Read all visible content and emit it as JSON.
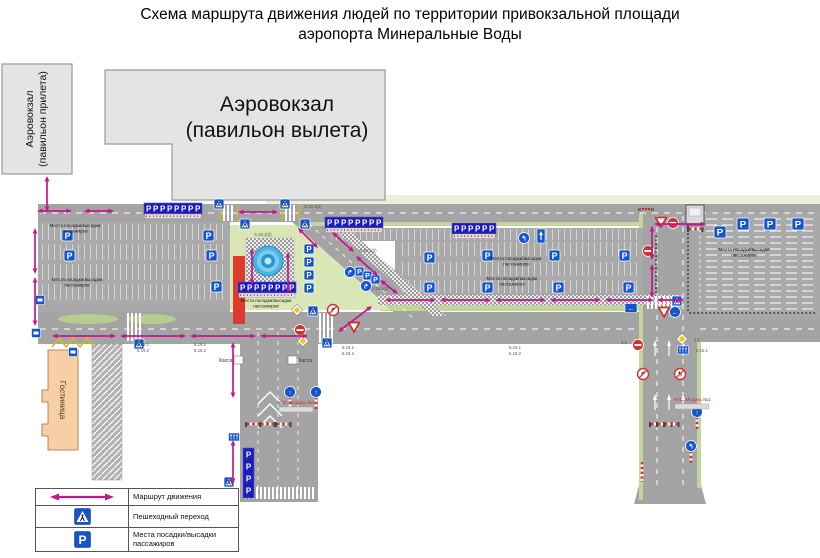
{
  "title": {
    "line1": "Схема маршрута движения людей по территории привокзальной площади",
    "line2": "аэропорта Минеральные Воды"
  },
  "buildings": {
    "arrival_line1": "Аэровокзал",
    "arrival_line2": "(павильон прилета)",
    "departure_line1": "Аэровокзал",
    "departure_line2": "(павильон вылета)",
    "hotel": "Гостиница"
  },
  "legend": {
    "route": "Маршрут движения",
    "crosswalk": "Пешеходный переход",
    "boarding": "Места посадки/высадки пассажиров",
    "p_letter": "P"
  },
  "colors": {
    "route": "#c2188c",
    "sign_blue": "#1455cc",
    "row_blue": "#1c1cb8",
    "road": "#a4a4a4",
    "green": "#d9e6b5",
    "fountain": "#49b4e6",
    "red_strip": "#e03a2e",
    "hotel": "#f6cfa6",
    "building": "#e4e4e4",
    "aps_red": "#d42222",
    "sign_red": "#d43030"
  },
  "map": {
    "p_letter": "P",
    "boarding_line1": "Места посадки/высадки",
    "boarding_line2": "пассажиров",
    "boarding_positions": [
      [
        75,
        227
      ],
      [
        77,
        281
      ],
      [
        266,
        302
      ],
      [
        516,
        260
      ],
      [
        512,
        280
      ],
      [
        744,
        251
      ]
    ],
    "kassa": {
      "label": "Касса",
      "positions": [
        [
          234,
          356,
          "left"
        ],
        [
          288,
          356,
          "right"
        ]
      ]
    },
    "aps": [
      {
        "label": "АПС. Модуль №2",
        "x": 296,
        "y": 404
      },
      {
        "label": "АПС. Модуль №1",
        "x": 692,
        "y": 401
      }
    ],
    "code_labels": [
      [
        313,
        208,
        "5.19.1(2)"
      ],
      [
        263,
        236,
        "5.19.1(2)"
      ],
      [
        368,
        252,
        "5.19.1(2)"
      ],
      [
        380,
        290,
        "5.19.1(2)"
      ],
      [
        143,
        346,
        "5.19.1"
      ],
      [
        143,
        352,
        "5.19.2"
      ],
      [
        200,
        346,
        "5.19.1"
      ],
      [
        200,
        352,
        "5.19.2"
      ],
      [
        348,
        349,
        "5.19.1"
      ],
      [
        348,
        355,
        "5.19.2"
      ],
      [
        515,
        349,
        "5.19.1"
      ],
      [
        515,
        355,
        "5.19.2"
      ],
      [
        624,
        344,
        "3.1"
      ],
      [
        697,
        341,
        "2.1"
      ],
      [
        702,
        352,
        "5.15.1"
      ]
    ],
    "p_signs": [
      [
        62,
        230,
        11
      ],
      [
        64,
        250,
        11
      ],
      [
        203,
        230,
        11
      ],
      [
        206,
        250,
        11
      ],
      [
        211,
        281,
        11
      ],
      [
        304,
        244,
        10
      ],
      [
        304,
        257,
        10
      ],
      [
        304,
        270,
        10
      ],
      [
        304,
        283,
        10
      ],
      [
        355,
        267,
        9
      ],
      [
        363,
        271,
        9
      ],
      [
        371,
        275,
        9
      ],
      [
        424,
        252,
        11
      ],
      [
        482,
        250,
        11
      ],
      [
        549,
        250,
        11
      ],
      [
        619,
        250,
        11
      ],
      [
        424,
        282,
        11
      ],
      [
        482,
        282,
        11
      ],
      [
        553,
        282,
        11
      ],
      [
        623,
        282,
        11
      ],
      [
        714,
        226,
        12
      ],
      [
        737,
        218,
        12
      ],
      [
        764,
        218,
        12
      ],
      [
        792,
        218,
        12
      ],
      [
        228,
        490,
        10
      ]
    ],
    "p_rows": [
      [
        144,
        203,
        8,
        "h"
      ],
      [
        325,
        217,
        8,
        "h"
      ],
      [
        452,
        223,
        6,
        "h"
      ],
      [
        238,
        282,
        8,
        "h"
      ],
      [
        243,
        448,
        4,
        "v"
      ]
    ],
    "crosswalks": [
      [
        222,
        205,
        14,
        16,
        1
      ],
      [
        284,
        205,
        14,
        16,
        1
      ],
      [
        318,
        313,
        16,
        30,
        0
      ],
      [
        646,
        296,
        34,
        13,
        0
      ],
      [
        243,
        487,
        74,
        12,
        0
      ],
      [
        126,
        313,
        16,
        28,
        0
      ]
    ],
    "arrows": [
      [
        47,
        176,
        47,
        212
      ],
      [
        35,
        228,
        35,
        274
      ],
      [
        35,
        277,
        35,
        326
      ],
      [
        252,
        248,
        252,
        285
      ],
      [
        288,
        252,
        288,
        293
      ],
      [
        652,
        226,
        652,
        260
      ],
      [
        652,
        264,
        652,
        298
      ],
      [
        233,
        342,
        233,
        398
      ],
      [
        233,
        440,
        233,
        484
      ],
      [
        37,
        211,
        72,
        211
      ],
      [
        84,
        211,
        114,
        211
      ],
      [
        238,
        212,
        278,
        212
      ],
      [
        52,
        336,
        116,
        336
      ],
      [
        120,
        336,
        186,
        336
      ],
      [
        190,
        336,
        256,
        336
      ],
      [
        260,
        336,
        308,
        336
      ],
      [
        654,
        224,
        706,
        224
      ],
      [
        385,
        300,
        436,
        300
      ],
      [
        440,
        300,
        491,
        300
      ],
      [
        495,
        300,
        546,
        300
      ],
      [
        550,
        300,
        601,
        300
      ],
      [
        605,
        300,
        654,
        300
      ],
      [
        657,
        300,
        684,
        300
      ],
      [
        298,
        228,
        318,
        248
      ],
      [
        332,
        232,
        354,
        252
      ],
      [
        356,
        256,
        378,
        276
      ],
      [
        380,
        280,
        398,
        294
      ],
      [
        338,
        332,
        372,
        306
      ]
    ],
    "signs": [
      [
        "ped",
        214,
        199
      ],
      [
        "ped",
        240,
        219
      ],
      [
        "ped",
        280,
        199
      ],
      [
        "ped",
        300,
        219
      ],
      [
        "ped",
        308,
        306
      ],
      [
        "ped",
        322,
        338
      ],
      [
        "ped",
        134,
        339
      ],
      [
        "ped",
        672,
        296
      ],
      [
        "ped",
        224,
        477
      ],
      [
        "noentry",
        673,
        223
      ],
      [
        "noentry",
        648,
        251
      ],
      [
        "noentry",
        638,
        345
      ],
      [
        "noentry",
        300,
        330
      ],
      [
        "giveway",
        661,
        222
      ],
      [
        "giveway",
        354,
        327
      ],
      [
        "giveway",
        664,
        312
      ],
      [
        "mainroad",
        297,
        310
      ],
      [
        "mainroad",
        303,
        341
      ],
      [
        "mainroad",
        682,
        339
      ],
      [
        "noturn",
        333,
        310,
        "↱"
      ],
      [
        "noturn",
        643,
        374,
        "↱"
      ],
      [
        "noturn",
        680,
        374,
        "↰"
      ],
      [
        "bluedir",
        350,
        272,
        "↱"
      ],
      [
        "bluedir",
        366,
        286,
        "↱"
      ],
      [
        "bluedir",
        524,
        238,
        "↰"
      ],
      [
        "bluedir",
        675,
        312,
        "←"
      ],
      [
        "poledir",
        290,
        392,
        "↑"
      ],
      [
        "poledir",
        316,
        392,
        "↑"
      ],
      [
        "poledir",
        697,
        412,
        "↑"
      ],
      [
        "poledir",
        691,
        446,
        "↰"
      ],
      [
        "onewayV",
        541,
        236
      ],
      [
        "bluearrow",
        631,
        308
      ],
      [
        "lanes",
        683,
        350
      ],
      [
        "lanes",
        234,
        437
      ],
      [
        "bluesq",
        40,
        300
      ],
      [
        "bluesq",
        36,
        333
      ],
      [
        "bluesq",
        73,
        352
      ],
      [
        "pole",
        642,
        462,
        20
      ],
      [
        "gate",
        253,
        424
      ],
      [
        "gate",
        267,
        424
      ],
      [
        "gate",
        283,
        424
      ],
      [
        "gate",
        657,
        424
      ],
      [
        "gate",
        664,
        424
      ],
      [
        "gate",
        671,
        424
      ],
      [
        "gate",
        695,
        229
      ],
      [
        "dots",
        646,
        209
      ],
      [
        "kiosk",
        686,
        205
      ]
    ]
  }
}
